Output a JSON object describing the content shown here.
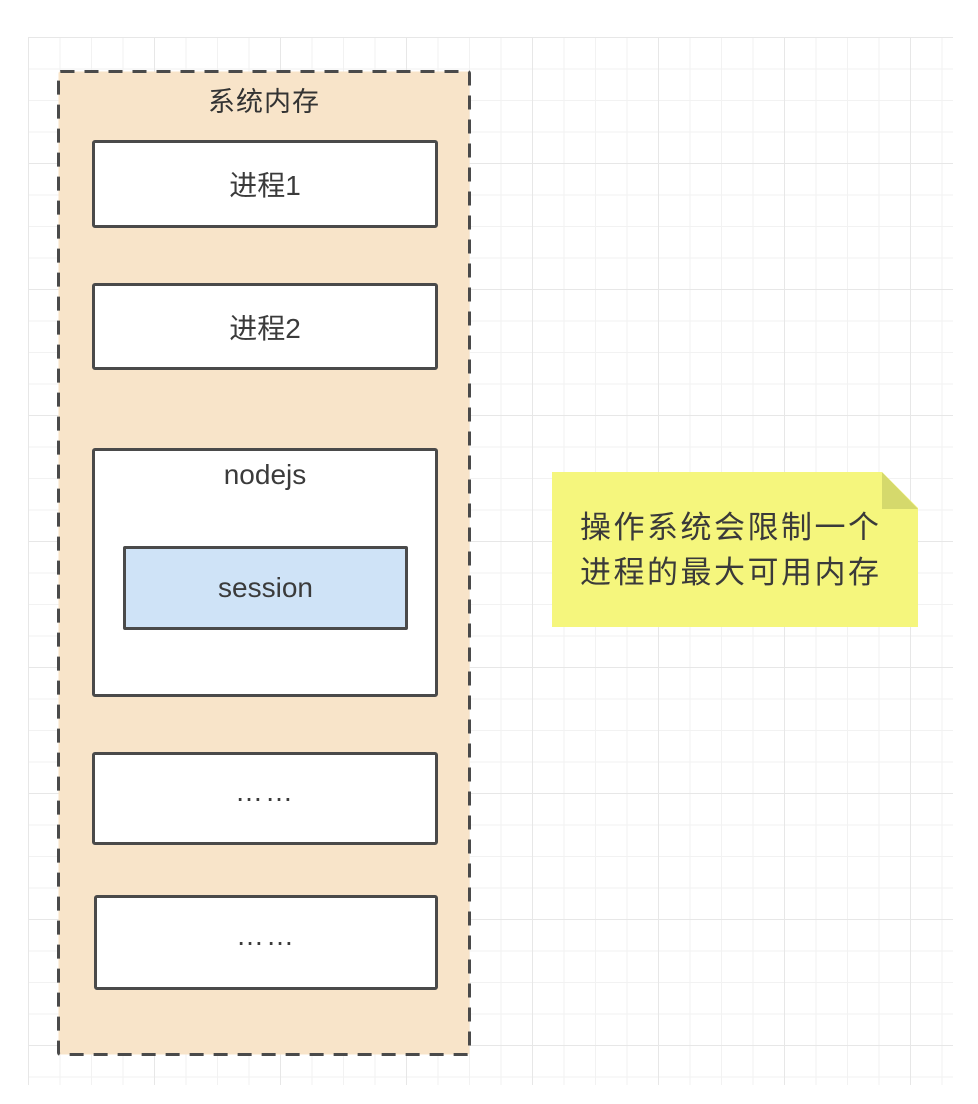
{
  "diagram": {
    "container": {
      "label": "系统内存",
      "fill_color": "#f8e4c9",
      "border_color": "#4a4a4a"
    },
    "boxes": [
      {
        "label": "进程1"
      },
      {
        "label": "进程2"
      },
      {
        "label": "nodejs",
        "child": {
          "label": "session",
          "fill_color": "#cfe3f7"
        }
      },
      {
        "label": "……"
      },
      {
        "label": "……"
      }
    ],
    "note": {
      "lines": [
        "操作系统会限制一个",
        "进程的最大可用内存"
      ],
      "fill_color": "#f5f67d",
      "fold_color": "#d5d96c"
    },
    "grid": {
      "minor_line_color": "#f2f2f2",
      "major_line_color": "#e7e7e7"
    }
  }
}
